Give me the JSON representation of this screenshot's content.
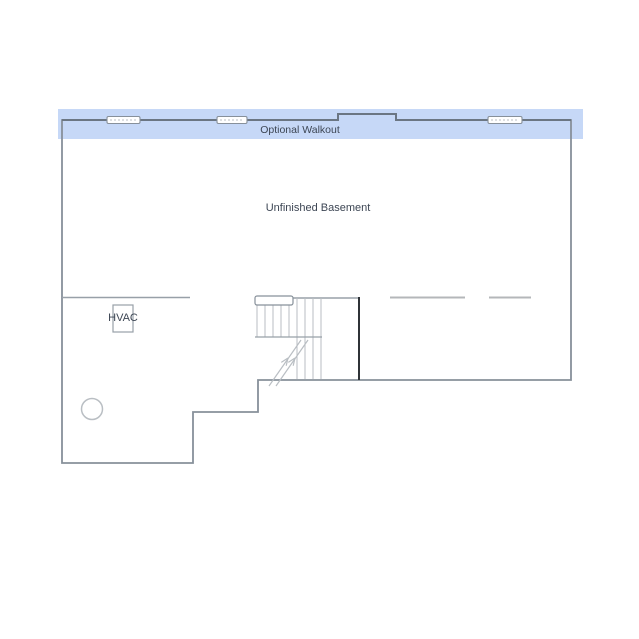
{
  "floorplan": {
    "walkout": {
      "label": "Optional Walkout",
      "window_count": "3"
    },
    "basement": {
      "label": "Unfinished Basement"
    },
    "hvac": {
      "label": "HVAC"
    },
    "colors": {
      "background": "#ffffff",
      "walkout_band": "#c6d8f7",
      "wall": "#87909a",
      "top_wall": "#6b7683",
      "interior_wall": "#98a0a8",
      "dash_line": "#b4b7ba",
      "stair_wall_dark": "#2f3337",
      "tread": "#b9bec3",
      "label_text": "#3d4654"
    }
  }
}
